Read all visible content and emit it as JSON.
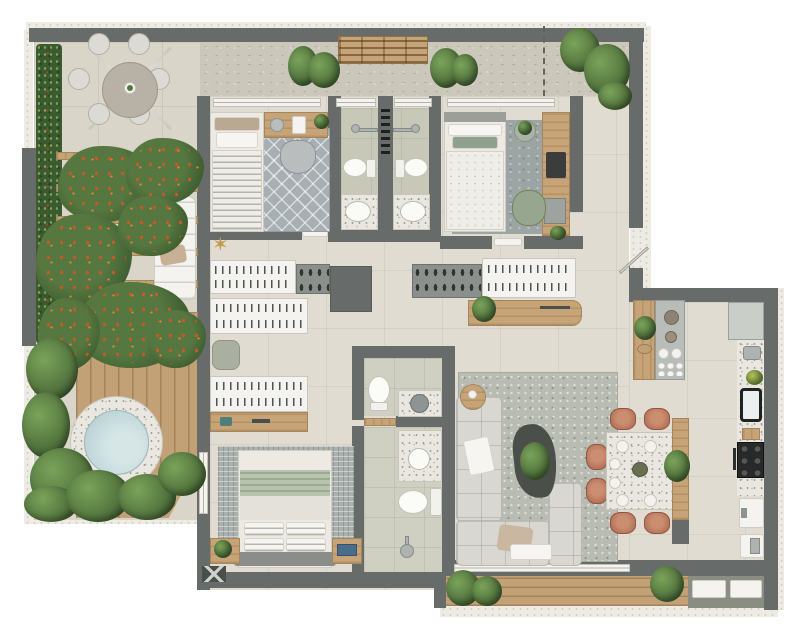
{
  "type": "architectural-floor-plan",
  "description": "Top-down 3D rendered apartment floor plan with wrap-around terrace; no text labels are visible in the image",
  "palette": {
    "wall": "#676c6a",
    "curb": "#edebe4",
    "floor": "#e0dcd1",
    "terrace_floor": "#d9d5c8",
    "concrete": "#cbc7ba",
    "bath_floor": "#c7c8b8",
    "wood": "#c6a478",
    "deck": "#c2a176",
    "green_dark": "#3c5a2f",
    "green": "#567840",
    "green_light": "#7aa35a",
    "flower": "#cd5826",
    "terrazzo": "#e9e7e0",
    "water": "#c4d9db",
    "sofa": "#d8d7d2",
    "terracotta": "#b5745b",
    "rug_living": "#b9bcb3",
    "rug_bedroom": "#a8afb3",
    "rug_bedroom2": "#9ca5a3",
    "rug_master": "#a9b0ad",
    "white_furniture": "#f4f3ef",
    "pouf": "#a9b0a1",
    "bed_green": "#b9c4ae",
    "cooktop": "#282a29",
    "fridge": "#c9cec9",
    "dark_furniture": "#4a4f4a",
    "books": "#4a6d8c",
    "gold": "#c49a4a"
  },
  "icons": {
    "starfish": "✶"
  },
  "elements": [
    "terrace",
    "vertical-garden",
    "outdoor-dining-table",
    "parasol",
    "pergola",
    "sun-lounger",
    "wood-deck",
    "hot-tub",
    "top-balcony",
    "slatted-bench",
    "boundary-dashed-line",
    "bedroom-1",
    "bedroom-2",
    "twin-bathrooms",
    "walk-in-closet",
    "entry-door",
    "master-bedroom",
    "master-bathroom",
    "guest-toilet",
    "living-room",
    "sofa",
    "coffee-table",
    "dining-table",
    "dining-chairs",
    "kitchen",
    "kitchen-island",
    "refrigerator",
    "cooktop",
    "oven",
    "kitchen-sink",
    "service-balcony",
    "washer",
    "plants"
  ]
}
